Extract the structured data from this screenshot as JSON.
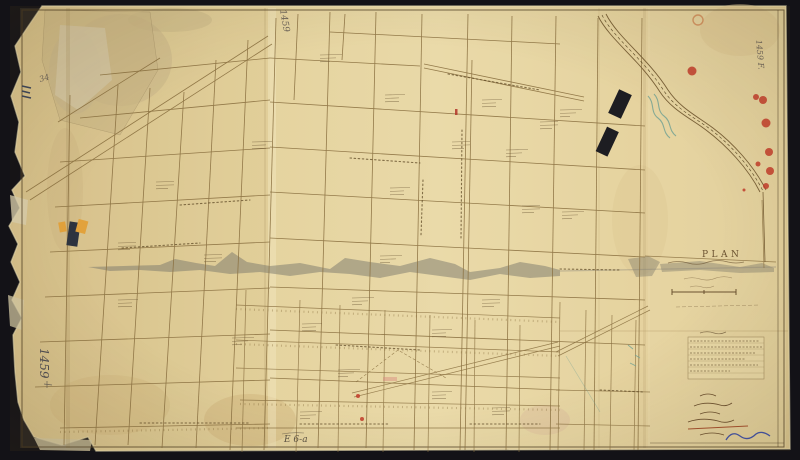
{
  "map": {
    "title_label": "PLAN",
    "archive_numbers": {
      "left_margin": "1459",
      "top_margin": "1459",
      "top_right_margin": "1459 F.",
      "corner_pencil": "34",
      "bottom_pencil": "E 6-a"
    },
    "colors": {
      "background": "#131217",
      "paper": "#e6d5a2",
      "ink": "#7a6138",
      "building_ink": "#1d1d22",
      "left_building_navy": "#2e3440",
      "building_orange": "#e2a23c",
      "wax_seal_red": "#c23b2a",
      "creek_teal": "#6fa093",
      "signature_blue": "#3f51a8",
      "graphite": "#4d4c52",
      "crease_gray": "#7a776b"
    }
  }
}
